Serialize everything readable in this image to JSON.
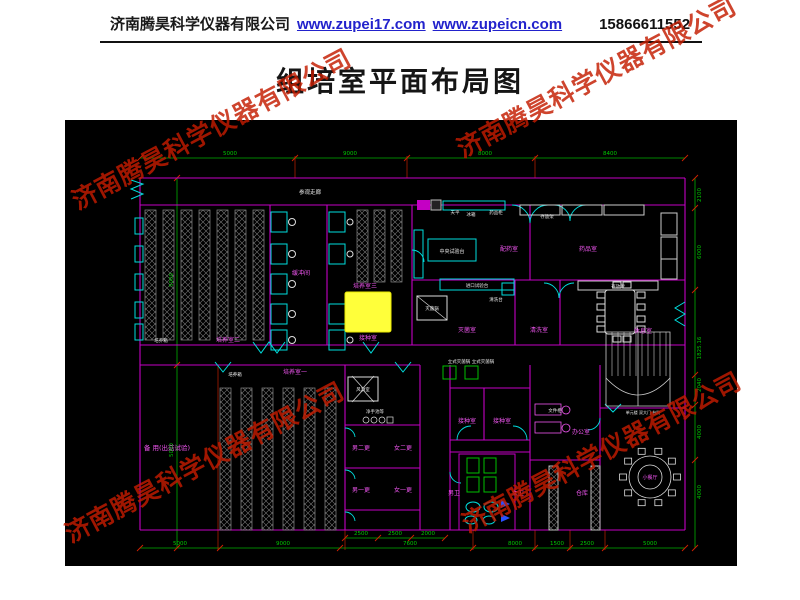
{
  "header": {
    "company": "济南腾昊科学仪器有限公司",
    "url1": "www.zupei17.com",
    "url2": "www.zupeicn.com",
    "phone": "15866611552",
    "link_color": "#2222cc"
  },
  "title": "组培室平面布局图",
  "watermark": {
    "text": "济南腾昊科学仪器有限公司",
    "color": "#c41c00"
  },
  "colors": {
    "wall": "#c400c4",
    "dimension": "#00b000",
    "tick": "#d42000",
    "fixture": "#00dede",
    "rack": "#8a8a8a",
    "highlight": "#ffff3a",
    "room_label": "#f055f0",
    "equipment_label": "#e9e9e9",
    "background": "#000000"
  },
  "plan": {
    "labels": [
      {
        "t": "参观走廊",
        "x": 245,
        "y": 74,
        "c": "w",
        "s": 5.5
      },
      {
        "t": "培养箱",
        "x": 96,
        "y": 222,
        "c": "w",
        "s": 4.5
      },
      {
        "t": "培养室二",
        "x": 163,
        "y": 222,
        "c": "m"
      },
      {
        "t": "缓冲间",
        "x": 236,
        "y": 155,
        "c": "m"
      },
      {
        "t": "培养室三",
        "x": 300,
        "y": 168,
        "c": "m"
      },
      {
        "t": "接种室",
        "x": 303,
        "y": 220,
        "c": "m"
      },
      {
        "t": "培养箱",
        "x": 170,
        "y": 256,
        "c": "w",
        "s": 4.5
      },
      {
        "t": "培养室一",
        "x": 230,
        "y": 254,
        "c": "m"
      },
      {
        "t": "备 用(出菇试验)",
        "x": 102,
        "y": 330,
        "c": "m",
        "s": 6.5
      },
      {
        "t": "风淋室",
        "x": 298,
        "y": 271,
        "c": "w",
        "s": 4.5
      },
      {
        "t": "净手池等",
        "x": 310,
        "y": 293,
        "c": "w",
        "s": 4.5
      },
      {
        "t": "男二更",
        "x": 296,
        "y": 330,
        "c": "m"
      },
      {
        "t": "女二更",
        "x": 338,
        "y": 330,
        "c": "m"
      },
      {
        "t": "男一更",
        "x": 296,
        "y": 372,
        "c": "m"
      },
      {
        "t": "女一更",
        "x": 338,
        "y": 372,
        "c": "m"
      },
      {
        "t": "天平",
        "x": 390,
        "y": 94,
        "c": "w",
        "s": 4.5
      },
      {
        "t": "冰箱",
        "x": 406,
        "y": 96,
        "c": "w",
        "s": 4.5
      },
      {
        "t": "药品柜",
        "x": 431,
        "y": 94,
        "c": "w",
        "s": 4.5
      },
      {
        "t": "中央试验台",
        "x": 387,
        "y": 133,
        "c": "w",
        "s": 5
      },
      {
        "t": "配药室",
        "x": 444,
        "y": 131,
        "c": "m"
      },
      {
        "t": "药品室",
        "x": 523,
        "y": 131,
        "c": "m"
      },
      {
        "t": "存放架",
        "x": 482,
        "y": 98,
        "c": "w",
        "s": 4.5
      },
      {
        "t": "进口试验台",
        "x": 412,
        "y": 167,
        "c": "w",
        "s": 4.5
      },
      {
        "t": "清洗台",
        "x": 431,
        "y": 181,
        "c": "w",
        "s": 4.5
      },
      {
        "t": "灭菌锅",
        "x": 367,
        "y": 190,
        "c": "w",
        "s": 4.5
      },
      {
        "t": "灭菌室",
        "x": 402,
        "y": 212,
        "c": "m"
      },
      {
        "t": "清洗室",
        "x": 474,
        "y": 212,
        "c": "m"
      },
      {
        "t": "存放架",
        "x": 553,
        "y": 168,
        "c": "w",
        "s": 4.5
      },
      {
        "t": "休息室",
        "x": 578,
        "y": 213,
        "c": "m"
      },
      {
        "t": "立式灭菌锅 立式灭菌锅",
        "x": 406,
        "y": 243,
        "c": "w",
        "s": 4.5
      },
      {
        "t": "接种室",
        "x": 402,
        "y": 303,
        "c": "m"
      },
      {
        "t": "接种室",
        "x": 437,
        "y": 303,
        "c": "m"
      },
      {
        "t": "文件柜",
        "x": 490,
        "y": 292,
        "c": "w",
        "s": 4.5
      },
      {
        "t": "办公室",
        "x": 516,
        "y": 314,
        "c": "m"
      },
      {
        "t": "男卫",
        "x": 389,
        "y": 375,
        "c": "m"
      },
      {
        "t": "女卫",
        "x": 453,
        "y": 375,
        "c": "m"
      },
      {
        "t": "仓库",
        "x": 517,
        "y": 375,
        "c": "m"
      },
      {
        "t": "小餐厅",
        "x": 585,
        "y": 359,
        "c": "m",
        "s": 5
      },
      {
        "t": "单元楼 双大门 台阶",
        "x": 578,
        "y": 294,
        "c": "w",
        "s": 4
      }
    ],
    "dims": [
      {
        "t": "5000",
        "x": 165,
        "y": 35
      },
      {
        "t": "9000",
        "x": 285,
        "y": 35
      },
      {
        "t": "8000",
        "x": 420,
        "y": 35
      },
      {
        "t": "8400",
        "x": 545,
        "y": 35
      },
      {
        "t": "5000",
        "x": 115,
        "y": 425
      },
      {
        "t": "9000",
        "x": 218,
        "y": 425
      },
      {
        "t": "7600",
        "x": 345,
        "y": 425
      },
      {
        "t": "8000",
        "x": 450,
        "y": 425
      },
      {
        "t": "1500",
        "x": 492,
        "y": 425
      },
      {
        "t": "2500",
        "x": 522,
        "y": 425
      },
      {
        "t": "5000",
        "x": 585,
        "y": 425
      },
      {
        "t": "2500",
        "x": 296,
        "y": 415
      },
      {
        "t": "2500",
        "x": 330,
        "y": 415
      },
      {
        "t": "2000",
        "x": 363,
        "y": 415
      },
      {
        "t": "5000",
        "x": 108,
        "y": 160,
        "r": 1
      },
      {
        "t": "5000",
        "x": 108,
        "y": 330,
        "r": 1
      },
      {
        "t": "2100",
        "x": 636,
        "y": 75,
        "r": 1
      },
      {
        "t": "6000",
        "x": 636,
        "y": 132,
        "r": 1
      },
      {
        "t": "1825.16",
        "x": 636,
        "y": 228,
        "r": 1
      },
      {
        "t": "2040",
        "x": 636,
        "y": 265,
        "r": 1
      },
      {
        "t": "4000",
        "x": 636,
        "y": 312,
        "r": 1
      },
      {
        "t": "4000",
        "x": 636,
        "y": 372,
        "r": 1
      }
    ]
  }
}
